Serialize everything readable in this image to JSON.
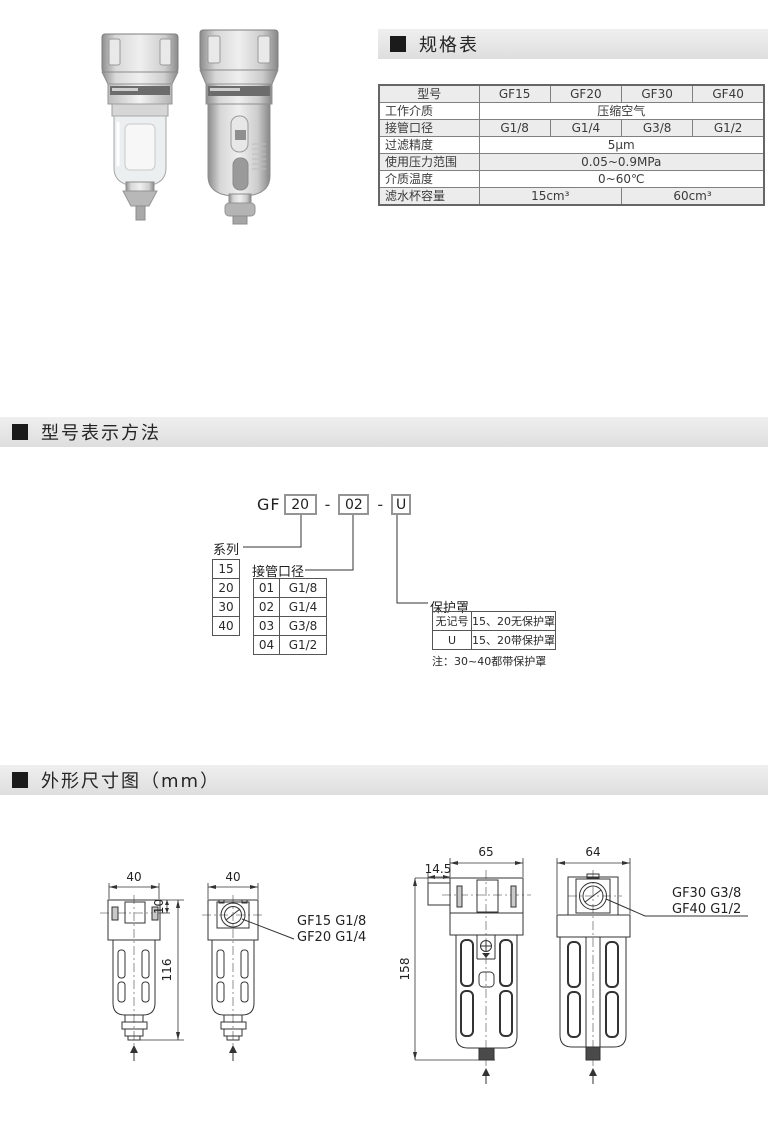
{
  "sections": {
    "spec": {
      "title": "规格表"
    },
    "model": {
      "title": "型号表示方法"
    },
    "dims": {
      "title": "外形尺寸图（mm）"
    }
  },
  "spec_table": {
    "header": {
      "label": "型号",
      "models": [
        "GF15",
        "GF20",
        "GF30",
        "GF40"
      ]
    },
    "work_medium": {
      "label": "工作介质",
      "value": "压缩空气"
    },
    "port_size": {
      "label": "接管口径",
      "values": [
        "G1/8",
        "G1/4",
        "G3/8",
        "G1/2"
      ]
    },
    "filtration": {
      "label": "过滤精度",
      "value": "5μm"
    },
    "pressure": {
      "label": "使用压力范围",
      "value": "0.05~0.9MPa"
    },
    "temperature": {
      "label": "介质温度",
      "value": "0~60℃"
    },
    "capacity": {
      "label": "滤水杯容量",
      "small": "15cm³",
      "large": "60cm³"
    }
  },
  "model_code": {
    "prefix": "GF",
    "size_value": "20",
    "dash1": "-",
    "port_value": "02",
    "dash2": "-",
    "cover_value": "U",
    "series": {
      "label": "系列",
      "options": [
        "15",
        "20",
        "30",
        "40"
      ]
    },
    "port": {
      "label": "接管口径",
      "options": [
        {
          "code": "01",
          "size": "G1/8"
        },
        {
          "code": "02",
          "size": "G1/4"
        },
        {
          "code": "03",
          "size": "G3/8"
        },
        {
          "code": "04",
          "size": "G1/2"
        }
      ]
    },
    "cover": {
      "label": "保护罩",
      "options": [
        {
          "code": "无记号",
          "desc": "15、20无保护罩"
        },
        {
          "code": "U",
          "desc": "15、20带保护罩"
        }
      ],
      "note": "注：30~40都带保护罩"
    }
  },
  "dimensions": {
    "small": {
      "front_width": "40",
      "side_width": "40",
      "height": "116",
      "port_depth": "10",
      "callout1": "GF15 G1/8",
      "callout2": "GF20 G1/4"
    },
    "large": {
      "front_width": "65",
      "side_width": "64",
      "height": "158",
      "bracket": "14.5",
      "callout1": "GF30 G3/8",
      "callout2": "GF40 G1/2"
    }
  }
}
